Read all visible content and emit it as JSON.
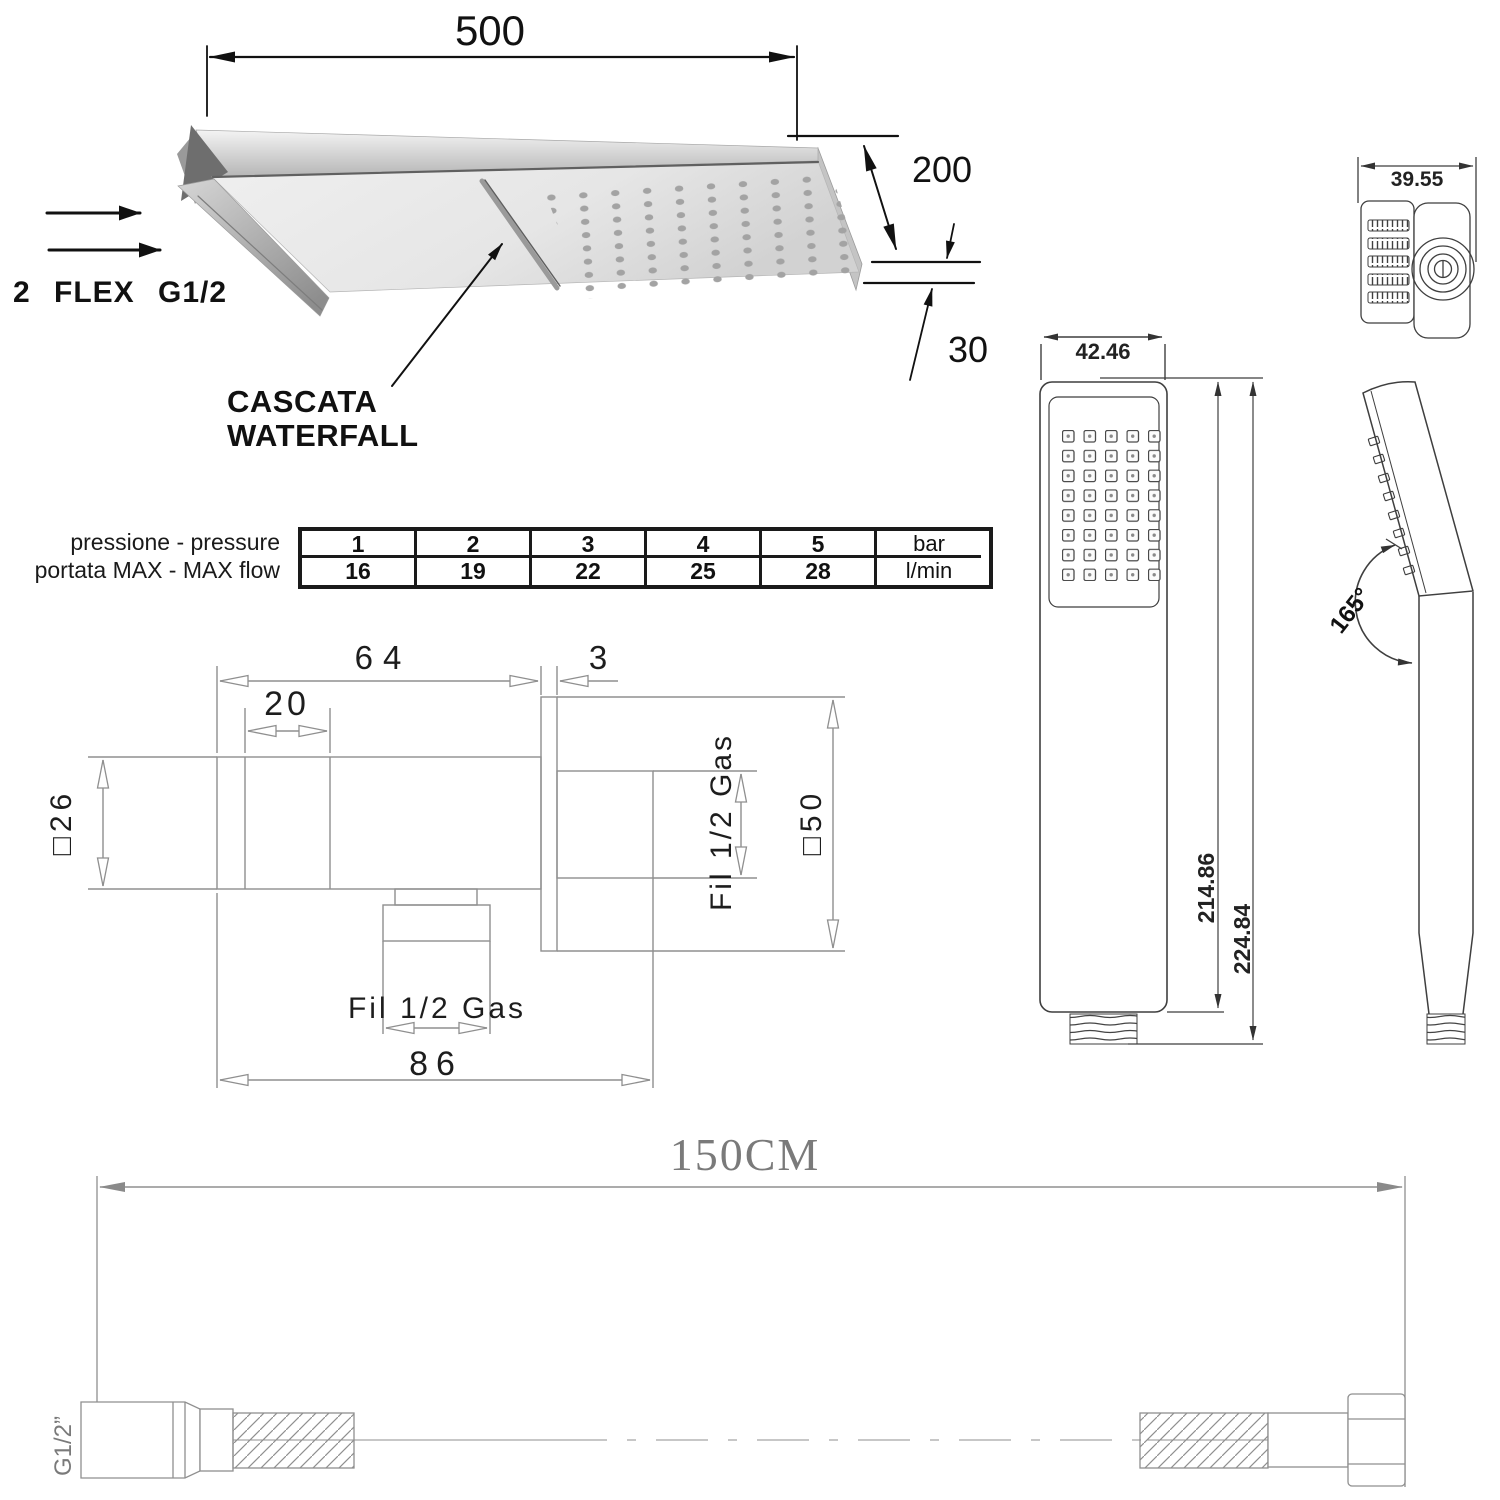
{
  "head3d": {
    "dim_length": "500",
    "dim_depth": "200",
    "dim_thickness": "30",
    "inlet_label": "2 FLEX G1/2",
    "callout_line1": "CASCATA",
    "callout_line2": "WATERFALL"
  },
  "flow_table": {
    "row1_label": "pressione - pressure",
    "row2_label": "portata MAX - MAX flow",
    "row1_values": [
      "1",
      "2",
      "3",
      "4",
      "5",
      "bar"
    ],
    "row2_values": [
      "16",
      "19",
      "22",
      "25",
      "28",
      "l/min"
    ]
  },
  "wall_union": {
    "dim_body_length": "64",
    "dim_plate_thickness": "3",
    "dim_front_section": "20",
    "dim_body_square": "□26",
    "dim_thread_side": "Fil 1/2 Gas",
    "dim_plate_square": "□50",
    "dim_thread_bottom": "Fil 1/2 Gas",
    "dim_total_depth": "86"
  },
  "handshower": {
    "dim_head_depth": "39.55",
    "dim_head_width": "42.46",
    "dim_body_height": "214.86",
    "dim_total_height": "224.84",
    "head_angle": "165°"
  },
  "hose": {
    "dim_length": "150CM",
    "thread_label": "G1/2”"
  }
}
